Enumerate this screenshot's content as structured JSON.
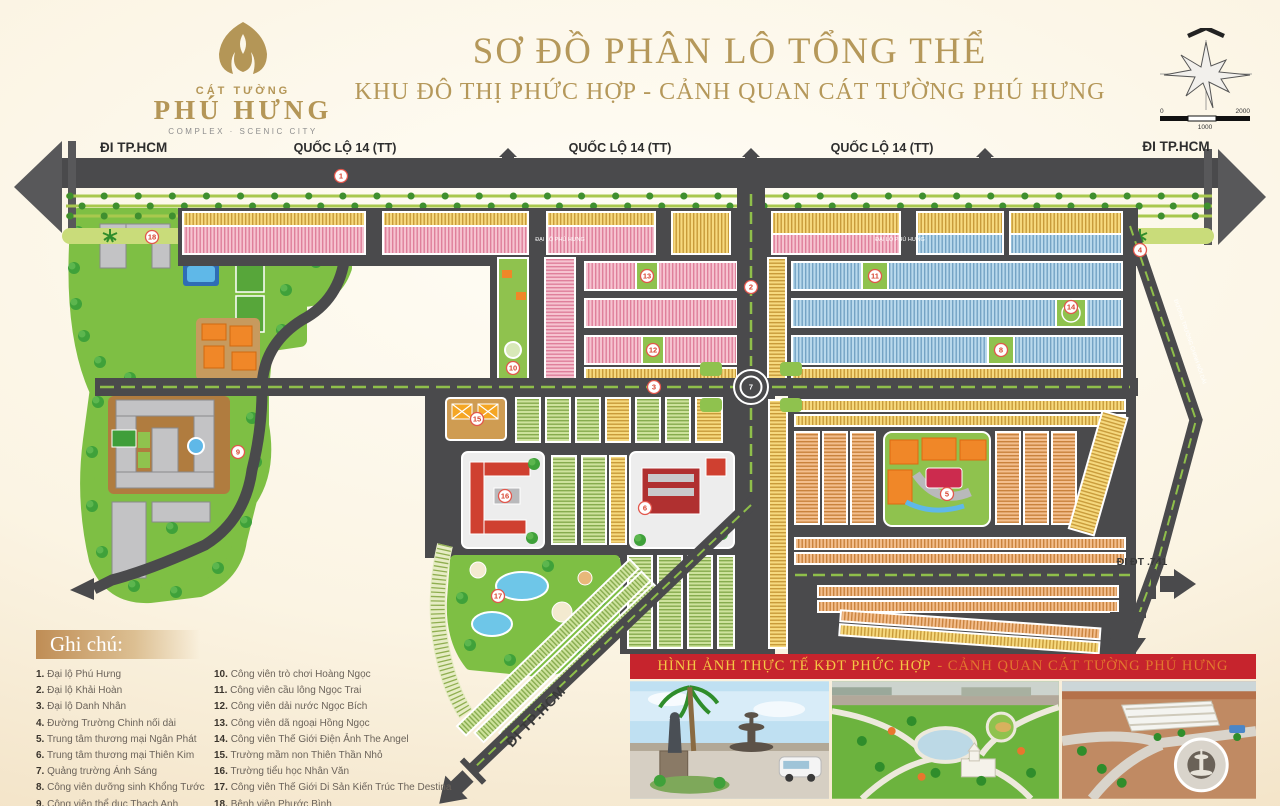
{
  "header": {
    "logo": {
      "brand_top": "CÁT TƯỜNG",
      "brand_main": "PHÚ HƯNG",
      "brand_sub": "COMPLEX · SCENIC CITY"
    },
    "title_line1": "SƠ ĐỒ PHÂN LÔ TỔNG THỂ",
    "title_line2": "KHU ĐÔ THỊ PHỨC HỢP - CẢNH QUAN CÁT TƯỜNG PHÚ HƯNG",
    "compass": {
      "scale_left": "0",
      "scale_mid": "1000",
      "scale_right": "2000"
    }
  },
  "map": {
    "labels": {
      "go_hcmc_left": "ĐI TP.HCM",
      "highway_1": "QUỐC LỘ 14 (TT)",
      "highway_2": "QUỐC LỘ 14 (TT)",
      "highway_3": "QUỐC LỘ 14 (TT)",
      "go_hcmc_right": "ĐI TP.HCM",
      "go_hcmc_bottom": "ĐI TP.HCM",
      "go_dt741": "ĐI ĐT .741",
      "avenue_median_1": "ĐẠI LỘ PHÚ HƯNG",
      "avenue_median_2": "ĐẠI LỘ PHÚ HƯNG",
      "truong_chinh_road": "ĐƯỜNG TRƯỜNG CHINH NỐI DÀI"
    },
    "markers": [
      {
        "label": "1"
      },
      {
        "label": "2"
      },
      {
        "label": "3"
      },
      {
        "label": "4"
      },
      {
        "label": "5"
      },
      {
        "label": "6"
      },
      {
        "label": "7"
      },
      {
        "label": "8"
      },
      {
        "label": "9"
      },
      {
        "label": "10"
      },
      {
        "label": "11"
      },
      {
        "label": "12"
      },
      {
        "label": "13"
      },
      {
        "label": "14"
      },
      {
        "label": "15"
      },
      {
        "label": "16"
      },
      {
        "label": "17"
      },
      {
        "label": "18"
      }
    ]
  },
  "legend": {
    "title": "Ghi chú:",
    "items": [
      {
        "num": "1.",
        "text": "Đại lộ Phú Hưng"
      },
      {
        "num": "2.",
        "text": "Đại lộ Khải Hoàn"
      },
      {
        "num": "3.",
        "text": "Đại lộ Danh Nhân"
      },
      {
        "num": "4.",
        "text": "Đường Trường Chinh nối dài"
      },
      {
        "num": "5.",
        "text": "Trung tâm thương mại Ngân Phát"
      },
      {
        "num": "6.",
        "text": "Trung tâm thương mại Thiên Kim"
      },
      {
        "num": "7.",
        "text": "Quảng trường Ánh Sáng"
      },
      {
        "num": "8.",
        "text": "Công viên dưỡng sinh Khổng Tước"
      },
      {
        "num": "9.",
        "text": "Công viên thể dục Thạch Anh"
      },
      {
        "num": "10.",
        "text": "Công viên trò chơi Hoàng Ngọc"
      },
      {
        "num": "11.",
        "text": "Công viên cầu lông Ngọc Trai"
      },
      {
        "num": "12.",
        "text": "Công viên dải nước Ngọc Bích"
      },
      {
        "num": "13.",
        "text": "Công viên dã ngoại Hồng Ngọc"
      },
      {
        "num": "14.",
        "text": "Công viên Thế Giới Điện Ảnh The Angel"
      },
      {
        "num": "15.",
        "text": "Trường mầm non Thiên Thần Nhỏ"
      },
      {
        "num": "16.",
        "text": "Trường tiểu học Nhân Văn"
      },
      {
        "num": "17.",
        "text": "Công viên Thế Giới Di Sản Kiến Trúc The Destina"
      },
      {
        "num": "18.",
        "text": "Bệnh viện Phước Bình"
      }
    ]
  },
  "photos": {
    "banner_part1": "HÌNH ẢNH THỰC TẾ KĐT PHỨC HỢP",
    "banner_part2": "- CẢNH QUAN CÁT TƯỜNG PHÚ HƯNG"
  },
  "colors": {
    "accent_gold": "#b5985a",
    "banner_red": "#c6242d",
    "road": "#4a4a4c",
    "lot_pink": "#f6c3d0",
    "lot_yellow": "#f6d97e",
    "lot_blue": "#b9d9ec",
    "lot_green": "#cde29c",
    "lot_orange": "#f3be8d",
    "park_green": "#7ebf44"
  }
}
